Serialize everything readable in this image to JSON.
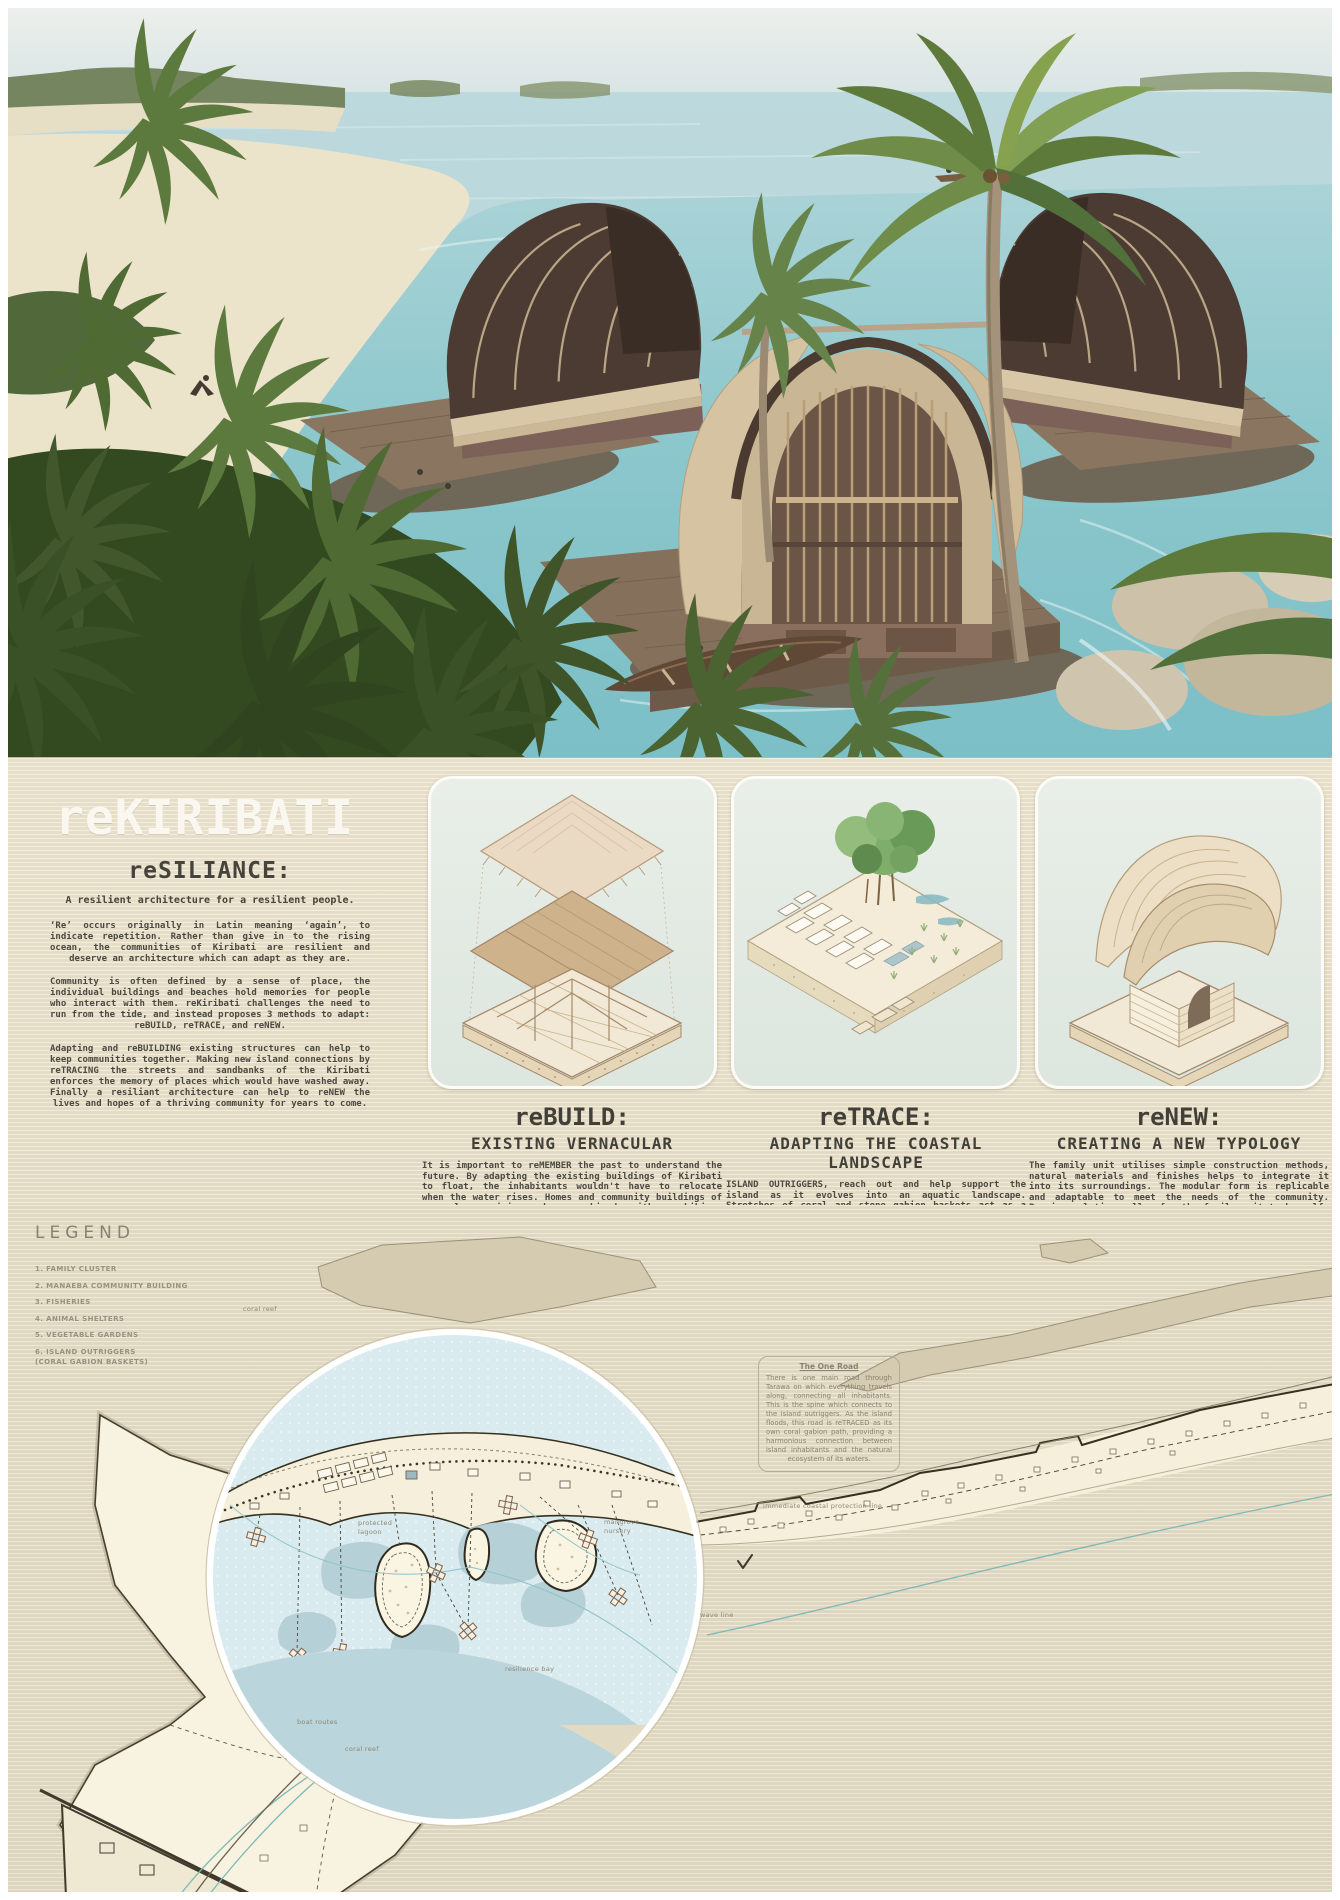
{
  "poster": {
    "title": "reKIRIBATI"
  },
  "intro": {
    "heading": "reSILIANCE:",
    "subheading": "A resilient architecture for a resilient people.",
    "paragraphs": [
      "‘Re’ occurs originally in Latin meaning ‘again’, to indicate repetition. Rather than give in to the rising ocean, the communities of Kiribati are resilient and deserve an architecture which can adapt as they are.",
      "Community is often defined by a sense of place, the individual buildings and beaches hold memories for people who interact with them. reKiribati challenges the need to run from the tide, and instead proposes 3 methods to adapt: reBUILD, reTRACE, and reNEW.",
      "Adapting and reBUILDING existing structures can help to keep communities together. Making new island connections by reTRACING the streets and sandbanks of the Kiribati enforces the memory of places which would have washed away. Finally a resiliant architecture can help to reNEW the lives and hopes of a thriving community for years to come."
    ]
  },
  "methods": [
    {
      "title": "reBUILD:",
      "subtitle": "EXISTING VERNACULAR",
      "body": "It is important to reMEMBER the past to understand the future. By adapting the existing buildings of Kiribati to float, the inhabitants wouldn't have to relocate when the water rises. Homes and community buildings of venacular origin, when combined with amphibious technology, allow for a new understanding of how we can adapt and live with water."
    },
    {
      "title": "reTRACE:",
      "subtitle": "ADAPTING THE COASTAL LANDSCAPE",
      "body": "ISLAND OUTRIGGERS, reach out and help support the island as it evolves into an aquatic landscape. Stretches of coral and stone gabion baskets act as a wave dampener and circulation for the family clusters. Providing a framework, not just for human inhabitation but for the wider ecosystem of the coastal waters of Kiribati."
    },
    {
      "title": "reNEW:",
      "subtitle": "CREATING A NEW TYPOLOGY",
      "body": "The family unit utilises simple construction methods, natural materials and finishes helps to integrate it into its surroundings. The modular form is replicable and adaptable to meet the needs of the community. Passive solutions allow for the family unit to be self-sufficient, creating a closer bond with nature."
    }
  ],
  "legend": {
    "title": "LEGEND",
    "items": [
      "1. FAMILY CLUSTER",
      "2. MANAEBA COMMUNITY BUILDING",
      "3. FISHERIES",
      "4. ANIMAL SHELTERS",
      "5. VEGETABLE GARDENS",
      "6. ISLAND OUTRIGGERS"
    ],
    "note": "(CORAL GABION BASKETS)"
  },
  "map": {
    "one_road": {
      "title": "The One Road",
      "body": "There is one main road through Tarawa on which everything travels along, connecting all inhabitants. This is the spine which connects to the island outriggers. As the island floods, this road is reTRACED as its own coral gabion path, providing a harmonious connection between island inhabitants and the natural ecosystem of its waters."
    },
    "labels": {
      "coral_reef_top": "coral reef",
      "protected_lagoon": "protected lagoon",
      "mangrove_nursery": "mangrove nursery",
      "resilience_bay": "resilience bay",
      "immediate_line": "immediate coastal protection line",
      "wave_line": "wave line",
      "boat_routes": "boat routes",
      "coral_reef_bottom": "coral reef"
    }
  },
  "colors": {
    "band_beige": "#e4dcc6",
    "panel_mint": "#e4ebe4",
    "title_white": "#f9f7f0",
    "text_dark": "#45433c",
    "label_gray": "#8e8672",
    "map_land_cream": "#f6efdc",
    "map_sea_blue": "#d9ebee",
    "bay_blue": "#bad5db",
    "teal_line": "#7fb8b6"
  }
}
